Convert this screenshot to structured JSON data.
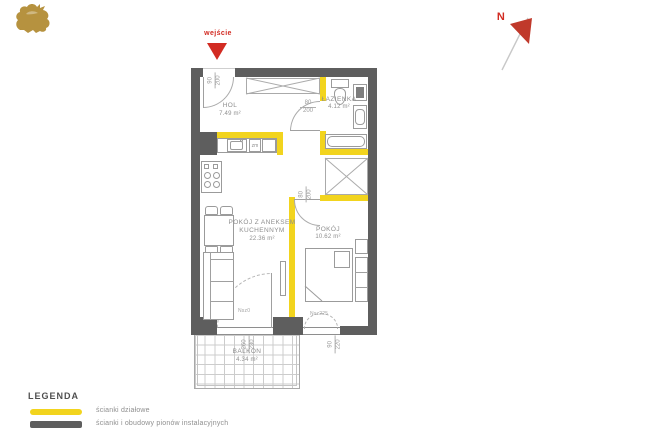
{
  "logo": {
    "name": "griffin-logo",
    "color": "#b6923f"
  },
  "compass": {
    "label": "N"
  },
  "entrance": {
    "label": "wejście",
    "dim": {
      "num": "90",
      "den": "200"
    }
  },
  "rooms": {
    "hol": {
      "name": "HOL",
      "area": "7.49 m²"
    },
    "bathroom": {
      "name": "ŁAZIENKA",
      "area": "4.12 m²",
      "door_dim": {
        "num": "80",
        "den": "200"
      }
    },
    "living": {
      "name_line1": "POKÓJ Z ANEKSEM",
      "name_line2": "KUCHENNYM",
      "area": "22.36 m²"
    },
    "bedroom": {
      "name": "POKÓJ",
      "area": "10.62 m²",
      "door_dim": {
        "num": "80",
        "den": "200"
      }
    },
    "balcony": {
      "name": "BALKON",
      "area": "4.34 m²"
    }
  },
  "openings": {
    "living_balcony_door": {
      "label": "Nsz0",
      "dim": {
        "num": "260",
        "den": "230"
      }
    },
    "bedroom_window": {
      "label": "Nsz225",
      "dim": {
        "num": "90",
        "den": "220"
      }
    }
  },
  "kitchen": {
    "dishwasher_label": "zm"
  },
  "legend": {
    "title": "LEGENDA",
    "items": [
      {
        "swatch_color": "#f2d41e",
        "label": "ścianki działowe"
      },
      {
        "swatch_color": "#5e5e5e",
        "label": "ścianki i obudowy pionów instalacyjnych"
      }
    ]
  },
  "colors": {
    "wall": "#5e5e5e",
    "partition_wall": "#f2d41e",
    "accent_red": "#d22b22",
    "logo_gold": "#b6923f"
  }
}
